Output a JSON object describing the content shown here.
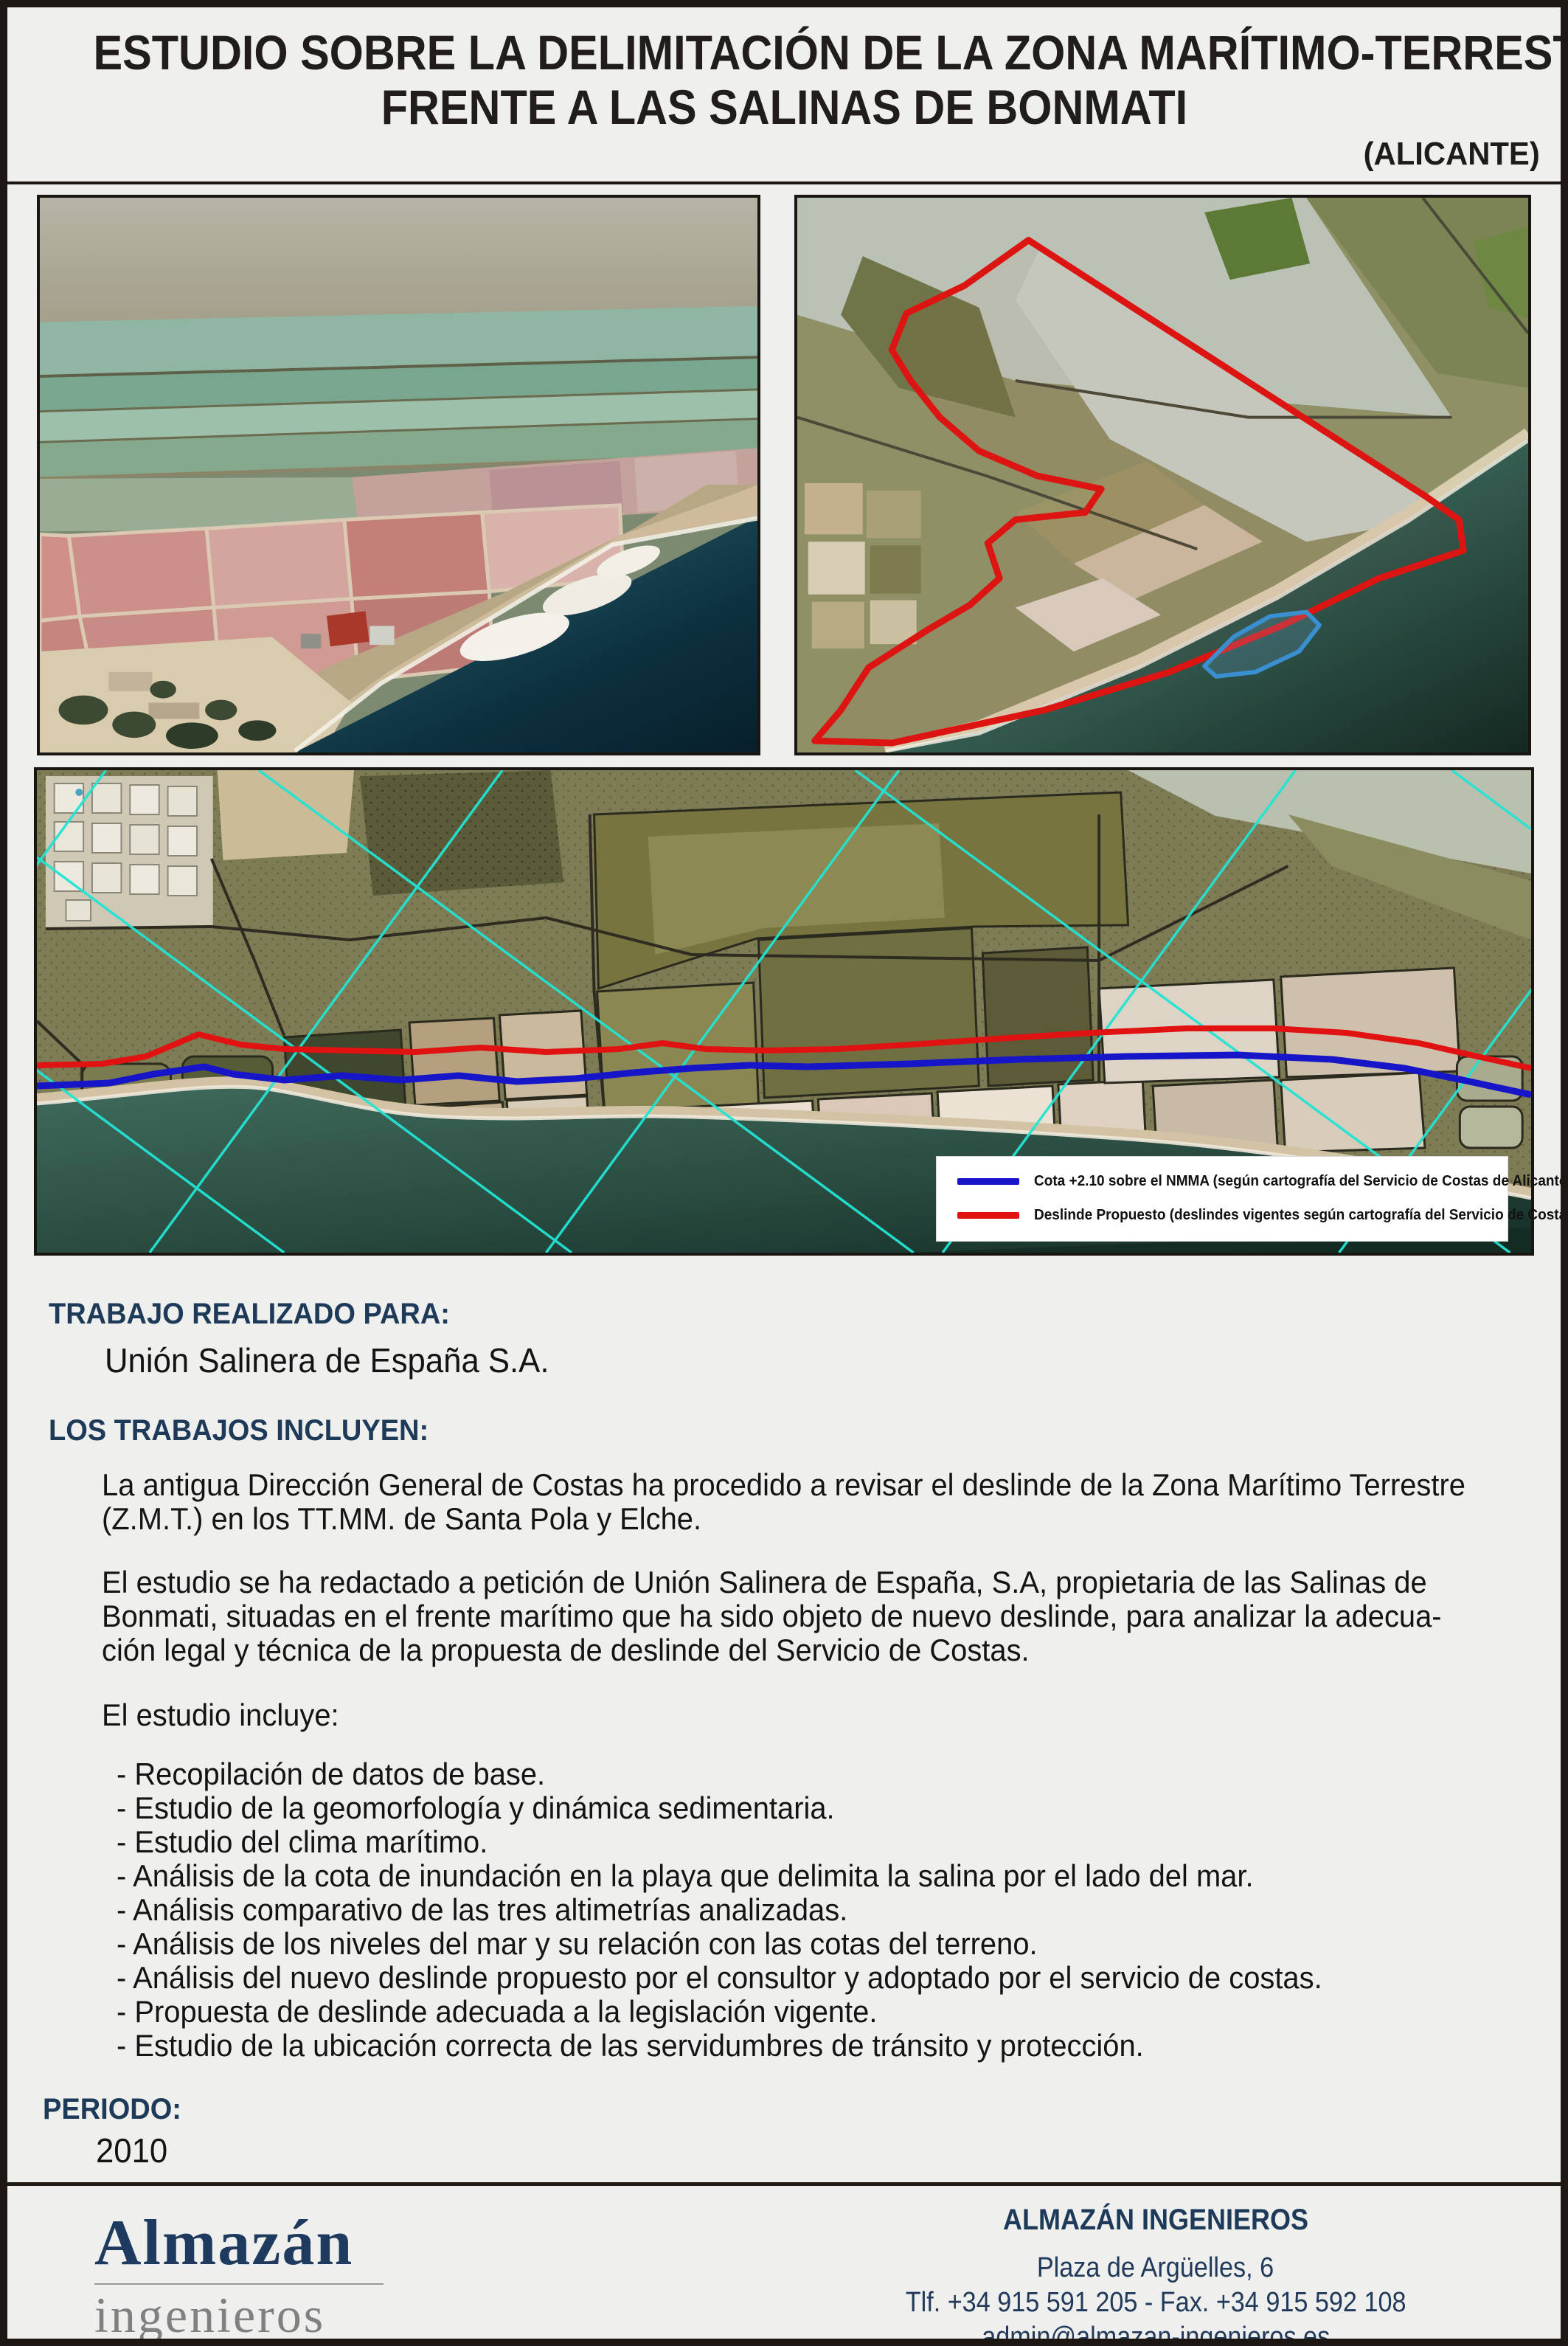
{
  "header": {
    "title_line1": "ESTUDIO SOBRE LA DELIMITACIÓN DE LA ZONA MARÍTIMO-TERRESTRE",
    "title_line2": "FRENTE A LAS SALINAS DE BONMATI",
    "province": "(ALICANTE)"
  },
  "strip": {
    "legend": {
      "items": [
        {
          "color": "#1616c8",
          "label": "Cota +2.10 sobre el NMMA (según cartografía del Servicio de Costas de Alicante)"
        },
        {
          "color": "#e01212",
          "label": "Deslinde Propuesto (deslindes vigentes según cartografía del Servicio de Costas de Alicante)"
        }
      ]
    }
  },
  "client": {
    "heading": "TRABAJO REALIZADO PARA:",
    "name": "Unión Salinera de España S.A."
  },
  "works": {
    "heading": "LOS TRABAJOS INCLUYEN:",
    "paragraph1_lines": [
      "La antigua Dirección General de Costas ha procedido a revisar el deslinde de la Zona Marítimo Terrestre",
      "(Z.M.T.) en los TT.MM. de Santa Pola y Elche."
    ],
    "paragraph2_lines": [
      "El estudio se ha redactado a petición de Unión Salinera de España, S.A, propietaria de las Salinas de",
      "Bonmati, situadas en el frente marítimo que ha sido objeto de nuevo deslinde, para analizar la adecua-",
      "ción legal y técnica de la propuesta de deslinde del Servicio de Costas."
    ],
    "includes_heading": "El estudio incluye:",
    "bullets": [
      "- Recopilación de datos de base.",
      "- Estudio de la geomorfología y dinámica sedimentaria.",
      "- Estudio del clima marítimo.",
      "- Análisis de la cota de inundación en la playa que delimita la salina por el lado del mar.",
      "- Análisis comparativo de las tres altimetrías analizadas.",
      "- Análisis de los niveles del mar y su relación con las cotas del terreno.",
      "- Análisis del nuevo deslinde propuesto por el consultor y adoptado por el servicio de costas.",
      "- Propuesta de deslinde adecuada a la legislación vigente.",
      "- Estudio de la ubicación correcta de las servidumbres de tránsito y protección."
    ]
  },
  "period": {
    "heading": "PERIODO:",
    "value": "2010"
  },
  "footer": {
    "logo_top": "Almazán",
    "logo_bottom": "ingenieros",
    "company": "ALMAZÁN INGENIEROS",
    "address": "Plaza de Argüelles, 6",
    "phone_fax": "Tlf. +34 915 591 205 - Fax. +34 915 592 108",
    "email": "admin@almazan-ingenieros.es",
    "website": "www.almazan-ingenieros.es"
  },
  "colors": {
    "accent_navy": "#1d3a59",
    "cota_line_blue": "#1616c8",
    "deslinde_line_red": "#e01212",
    "grid_cyan": "#22e4d4",
    "page_background": "#efefed"
  }
}
